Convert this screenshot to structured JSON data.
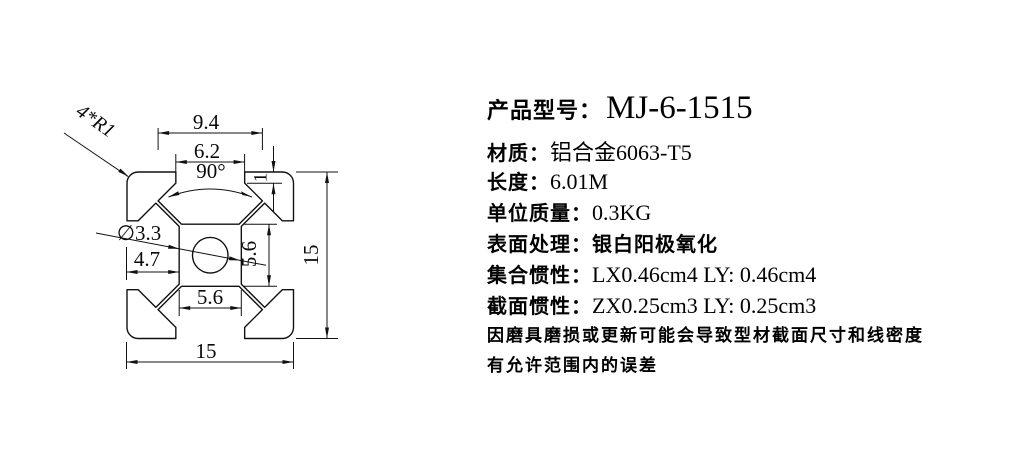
{
  "product": {
    "title_label": "产品型号：",
    "title_value": "MJ-6-1515",
    "specs": [
      {
        "label": "材质：",
        "value": "铝合金6063-T5"
      },
      {
        "label": "长度：",
        "value": "6.01M"
      },
      {
        "label": "单位质量：",
        "value": "0.3KG"
      },
      {
        "label": "表面处理：",
        "value": "银白阳极氧化"
      },
      {
        "label": "集合惯性：",
        "value": "LX0.46cm4 LY: 0.46cm4"
      },
      {
        "label": "截面惯性：",
        "value": "ZX0.25cm3 LY: 0.25cm3"
      }
    ],
    "notes": [
      "因磨具磨损或更新可能会导致型材截面尺寸和线密度",
      "有允许范围内的误差"
    ]
  },
  "drawing": {
    "dims": {
      "slot_inner_width": "9.4",
      "slot_opening": "6.2",
      "slot_angle": "90°",
      "lip_thickness": "1",
      "overall_height": "15",
      "center_hole": "∅3.3",
      "edge_to_core": "4.7",
      "core_height": "5.6",
      "core_width": "5.6",
      "overall_width": "15",
      "corner_radius": "4*R1"
    },
    "colors": {
      "line": "#111111",
      "text": "#000000"
    }
  }
}
